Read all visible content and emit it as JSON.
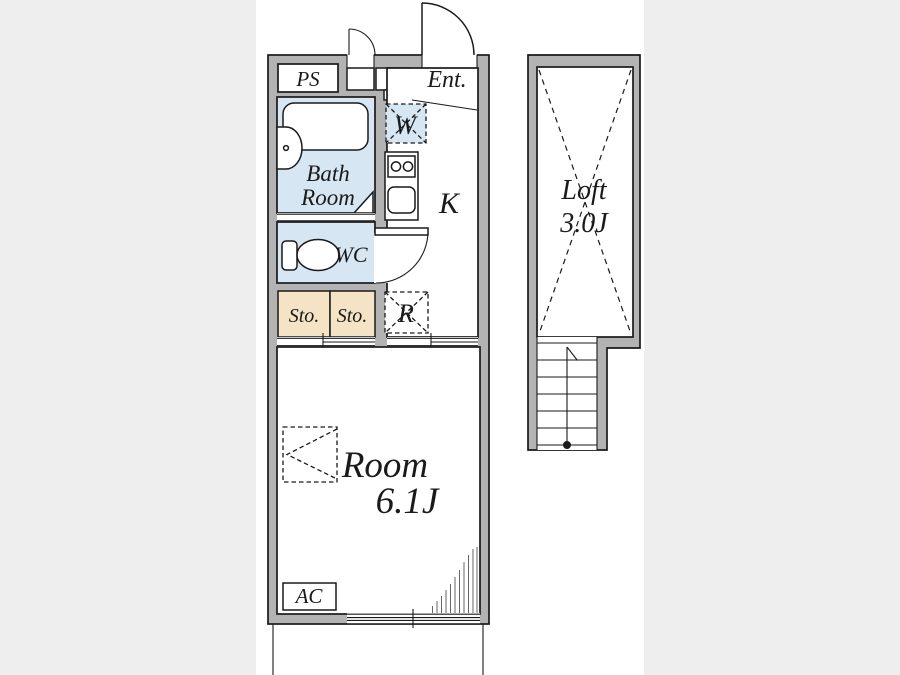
{
  "plan": {
    "kind": "apartment floor plan",
    "labels": {
      "ps": "PS",
      "ent": "Ent.",
      "bath1": "Bath",
      "bath2": "Room",
      "wc": "WC",
      "washer": "W",
      "kitchen": "K",
      "sto_left": "Sto.",
      "sto_right": "Sto.",
      "fridge": "R",
      "room": "Room",
      "room_size": "6.1J",
      "ac": "AC",
      "loft": "Loft",
      "loft_size": "3.0J"
    }
  },
  "colors": {
    "bg": "#eeeeee",
    "canvas": "#ffffff",
    "wall-gray": "#b3b3b3",
    "line": "#1a1a1a",
    "water-blue": "#d6e6f3",
    "storage-beige": "#f5e3c6",
    "hatch": "#666666"
  }
}
